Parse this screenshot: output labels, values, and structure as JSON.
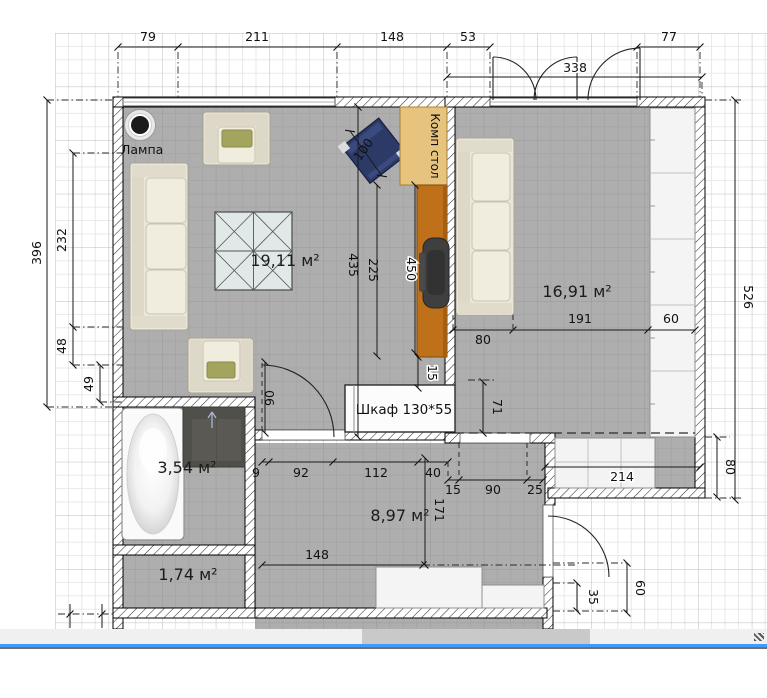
{
  "rooms": {
    "living": "19,11 м²",
    "bedroom": "16,91 м²",
    "bathroom": "3,54 м²",
    "hallway": "8,97 м²",
    "toilet": "1,74 м²"
  },
  "furniture": {
    "lamp": "Лампа",
    "computer_desk": "Комп стол",
    "wardrobe": "Шкаф 130*55"
  },
  "dimensions": {
    "top": {
      "d79": "79",
      "d211": "211",
      "d148": "148",
      "d53": "53",
      "d338": "338",
      "d77": "77"
    },
    "left": {
      "d396": "396",
      "d232": "232",
      "d48": "48",
      "d49": "49"
    },
    "right": {
      "d526": "526",
      "d80": "80",
      "d60": "60",
      "d35": "35"
    },
    "living": {
      "d435": "435",
      "d225": "225",
      "d450": "450",
      "d100": "100",
      "d90": "90",
      "d15": "15"
    },
    "bedroom": {
      "d80": "80",
      "d191": "191",
      "d60": "60",
      "d71": "71",
      "d214": "214"
    },
    "hallway": {
      "d9": "9",
      "d92": "92",
      "d112": "112",
      "d40": "40",
      "d15": "15",
      "d90": "90",
      "d25": "25",
      "d171": "171",
      "d148": "148"
    }
  },
  "colors": {
    "floor": "#aeaeae",
    "grid_minor": "#e3e3e3",
    "grid_major": "#bdbdbd",
    "scroll_accent": "#3f9bfc",
    "desk_tan": "#e7c47e",
    "desk_orange": "#bf7119",
    "chair_blue": "#2c3a68",
    "cushion_green": "#a3a55f"
  }
}
